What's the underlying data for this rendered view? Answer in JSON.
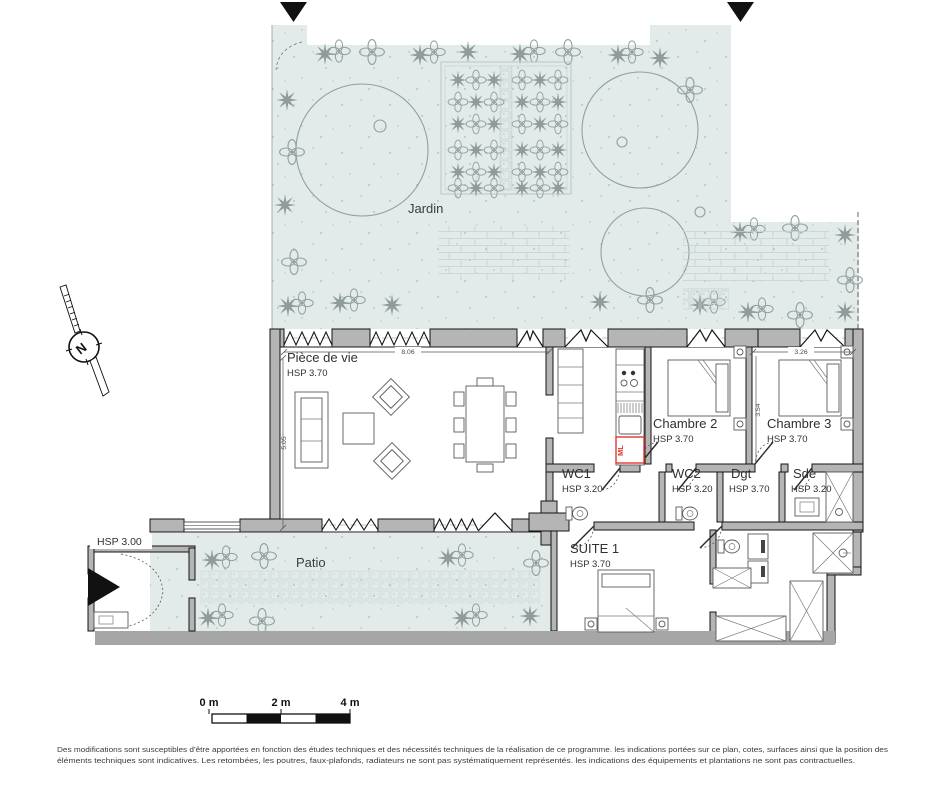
{
  "garden": {
    "label": "Jardin"
  },
  "patio": {
    "label": "Patio",
    "exterior_hsp": "HSP 3.00"
  },
  "rooms": {
    "living": {
      "name": "Pièce de vie",
      "hsp": "HSP 3.70"
    },
    "chambre2": {
      "name": "Chambre 2",
      "hsp": "HSP 3.70"
    },
    "chambre3": {
      "name": "Chambre 3",
      "hsp": "HSP 3.70"
    },
    "wc1": {
      "name": "WC1",
      "hsp": "HSP 3.20"
    },
    "wc2": {
      "name": "WC2",
      "hsp": "HSP 3.20"
    },
    "dgt": {
      "name": "Dgt",
      "hsp": "HSP 3.70"
    },
    "sde": {
      "name": "Sde",
      "hsp": "HSP 3.20"
    },
    "suite1": {
      "name": "SUITE 1",
      "hsp": "HSP 3.70"
    }
  },
  "dimensions": {
    "living_width_m": "8.06",
    "living_depth_m": "5.05",
    "chambre3_width_m": "3.26",
    "chambre_depth_m": "3.54"
  },
  "appliances": {
    "washing_machine": "ML"
  },
  "compass": {
    "north": "N"
  },
  "scale_bar": {
    "labels": [
      "0 m",
      "2 m",
      "4 m"
    ]
  },
  "disclaimer": {
    "line1": "Des modifications sont susceptibles d'être apportées en fonction des études techniques et des nécessités techniques de la réalisation de ce programme. les indications portées sur ce plan, cotes, surfaces ainsi que la position des",
    "line2": "éléments techniques sont indicatives. Les retombées, les poutres, faux-plafonds, radiateurs ne sont pas systématiquement représentés. les indications des équipements et plantations ne sont pas contractuelles."
  },
  "colors": {
    "garden_fill": "#e2ebe9",
    "plant_gray": "#93a09e",
    "wall_gray": "#b5b5b5",
    "washing_machine_red": "#e0372e"
  }
}
